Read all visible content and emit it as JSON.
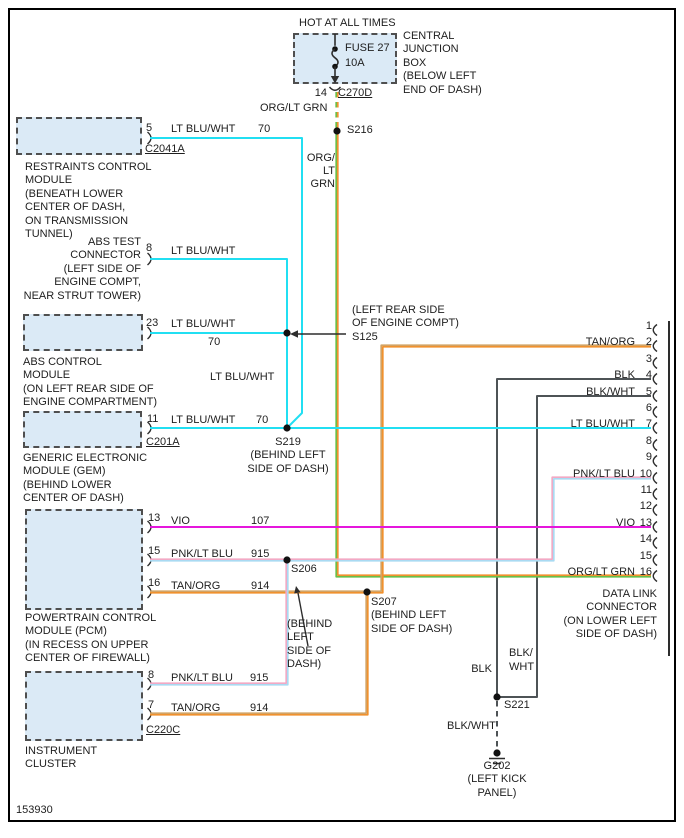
{
  "figure_number": "153930",
  "top": {
    "hot": "HOT AT ALL TIMES",
    "fuse": "FUSE 27\n10A",
    "cjb": "CENTRAL\nJUNCTION\nBOX\n(BELOW LEFT\nEND OF DASH)",
    "pin": "14",
    "connector": "C270D",
    "wire_top": "ORG/LT GRN",
    "splice": "S216",
    "wire_stack": "ORG/\nLT\nGRN"
  },
  "modules": {
    "restraints": {
      "pin": "5",
      "connector": "C2041A",
      "wire": "LT BLU/WHT",
      "circuit": "70",
      "label": "RESTRAINTS CONTROL\nMODULE\n(BENEATH LOWER\nCENTER OF DASH,\nON TRANSMISSION\nTUNNEL)"
    },
    "abs_test": {
      "pin": "8",
      "wire": "LT BLU/WHT",
      "label": "ABS TEST\nCONNECTOR\n(LEFT SIDE OF\nENGINE COMPT,\nNEAR STRUT TOWER)"
    },
    "abs_control": {
      "pin": "23",
      "wire": "LT BLU/WHT",
      "circuit": "70",
      "label": "ABS CONTROL\nMODULE\n(ON LEFT REAR SIDE OF\nENGINE COMPARTMENT)"
    },
    "gem": {
      "pin": "11",
      "connector": "C201A",
      "wire": "LT BLU/WHT",
      "circuit": "70",
      "label": "GENERIC ELECTRONIC\nMODULE (GEM)\n(BEHIND LOWER\nCENTER OF DASH)"
    },
    "pcm": {
      "row1": {
        "pin": "13",
        "wire": "VIO",
        "circuit": "107"
      },
      "row2": {
        "pin": "15",
        "wire": "PNK/LT BLU",
        "circuit": "915"
      },
      "row3": {
        "pin": "16",
        "wire": "TAN/ORG",
        "circuit": "914"
      },
      "label": "POWERTRAIN CONTROL\nMODULE (PCM)\n(IN RECESS ON UPPER\nCENTER OF FIREWALL)"
    },
    "cluster": {
      "row1": {
        "pin": "8",
        "wire": "PNK/LT BLU",
        "circuit": "915"
      },
      "row2": {
        "pin": "7",
        "wire": "TAN/ORG",
        "circuit": "914"
      },
      "connector": "C220C",
      "label": "INSTRUMENT\nCLUSTER"
    }
  },
  "mid": {
    "wire_mid": "LT BLU/WHT",
    "s125": "(LEFT REAR SIDE\nOF ENGINE COMPT)\nS125",
    "s219": "S219\n(BEHIND LEFT\nSIDE OF DASH)",
    "s206": "S206",
    "s206_loc": "(BEHIND\nLEFT\nSIDE OF\nDASH)",
    "s207": "S207\n(BEHIND LEFT\nSIDE OF DASH)"
  },
  "dlc": {
    "label": "DATA LINK\nCONNECTOR\n(ON LOWER LEFT\nSIDE OF DASH)",
    "pins": [
      "1",
      "2",
      "3",
      "4",
      "5",
      "6",
      "7",
      "8",
      "9",
      "10",
      "11",
      "12",
      "13",
      "14",
      "15",
      "16"
    ],
    "wires": {
      "2": "TAN/ORG",
      "4": "BLK",
      "5": "BLK/WHT",
      "7": "LT BLU/WHT",
      "10": "PNK/LT BLU",
      "13": "VIO",
      "16": "ORG/LT GRN"
    }
  },
  "ground": {
    "blk": "BLK",
    "blk_wht_stack": "BLK/\nWHT",
    "s221": "S221",
    "blk_wht": "BLK/WHT",
    "g202": "G202\n(LEFT KICK\nPANEL)"
  },
  "colors": {
    "lt_blu_wht": "#21dff2",
    "vio": "#e517dc",
    "pnk": "#f2a9c4",
    "lt_blu": "#a9daf2",
    "tan": "#d2a365",
    "org": "#f0912e",
    "lt_grn": "#68bf49",
    "blk_wire": "#4e5356",
    "box_fill": "#dbeaf6"
  }
}
